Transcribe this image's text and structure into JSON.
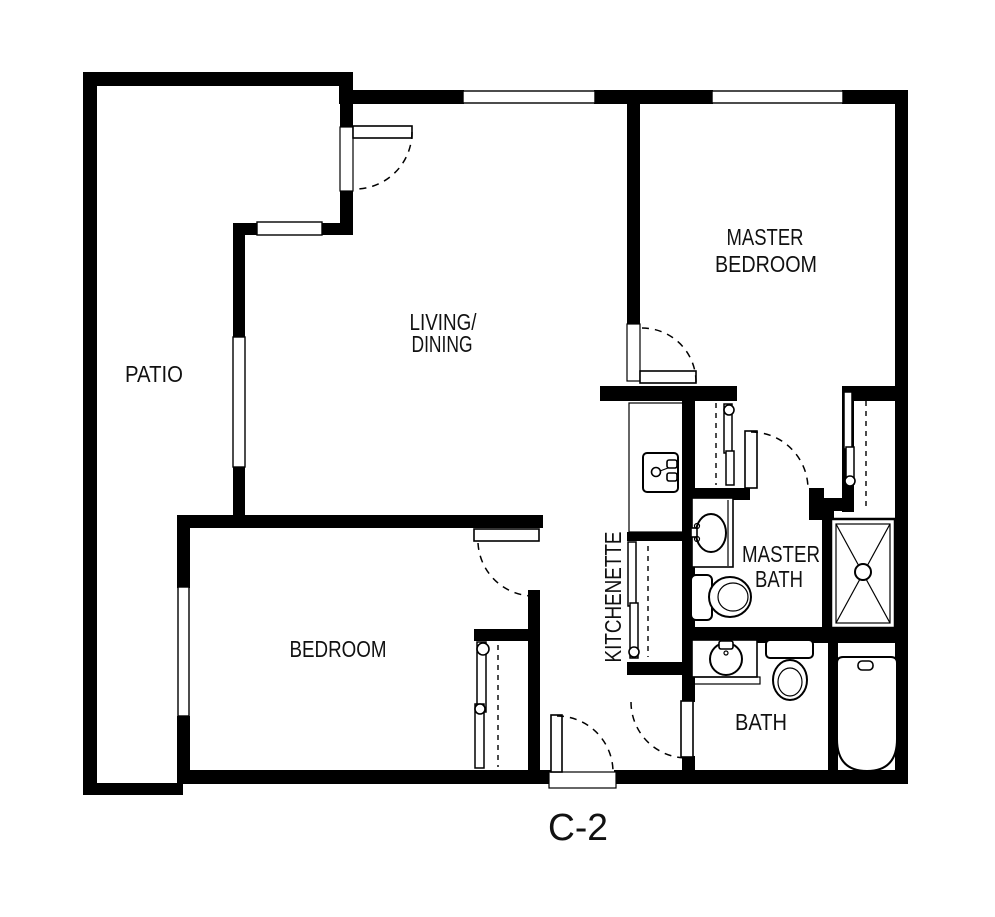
{
  "plan_title": "C-2",
  "rooms": [
    {
      "id": "patio",
      "lines": [
        "PATIO"
      ]
    },
    {
      "id": "living-dining",
      "lines": [
        "LIVING/",
        "DINING"
      ]
    },
    {
      "id": "master-bedroom",
      "lines": [
        "MASTER",
        "BEDROOM"
      ]
    },
    {
      "id": "bedroom",
      "lines": [
        "BEDROOM"
      ]
    },
    {
      "id": "kitchenette",
      "lines": [
        "KITCHENETTE"
      ]
    },
    {
      "id": "master-bath",
      "lines": [
        "MASTER",
        "BATH"
      ]
    },
    {
      "id": "bath",
      "lines": [
        "BATH"
      ]
    }
  ],
  "fixtures": [
    "kitchenette-sink",
    "kitchenette-pantry-bifold",
    "master-bath-vanity-sink",
    "master-bath-toilet",
    "master-bath-shower",
    "bath-vanity-sink",
    "bath-toilet",
    "bathtub",
    "bedroom-closet-bifold",
    "hall-closet-left-bifold",
    "hall-closet-right-bifold",
    "patio-door",
    "master-bedroom-door",
    "master-bath-door",
    "bath-door",
    "bedroom-door",
    "entry-door"
  ],
  "colors": {
    "wall": "#000000",
    "background": "#ffffff",
    "text": "#111111"
  }
}
